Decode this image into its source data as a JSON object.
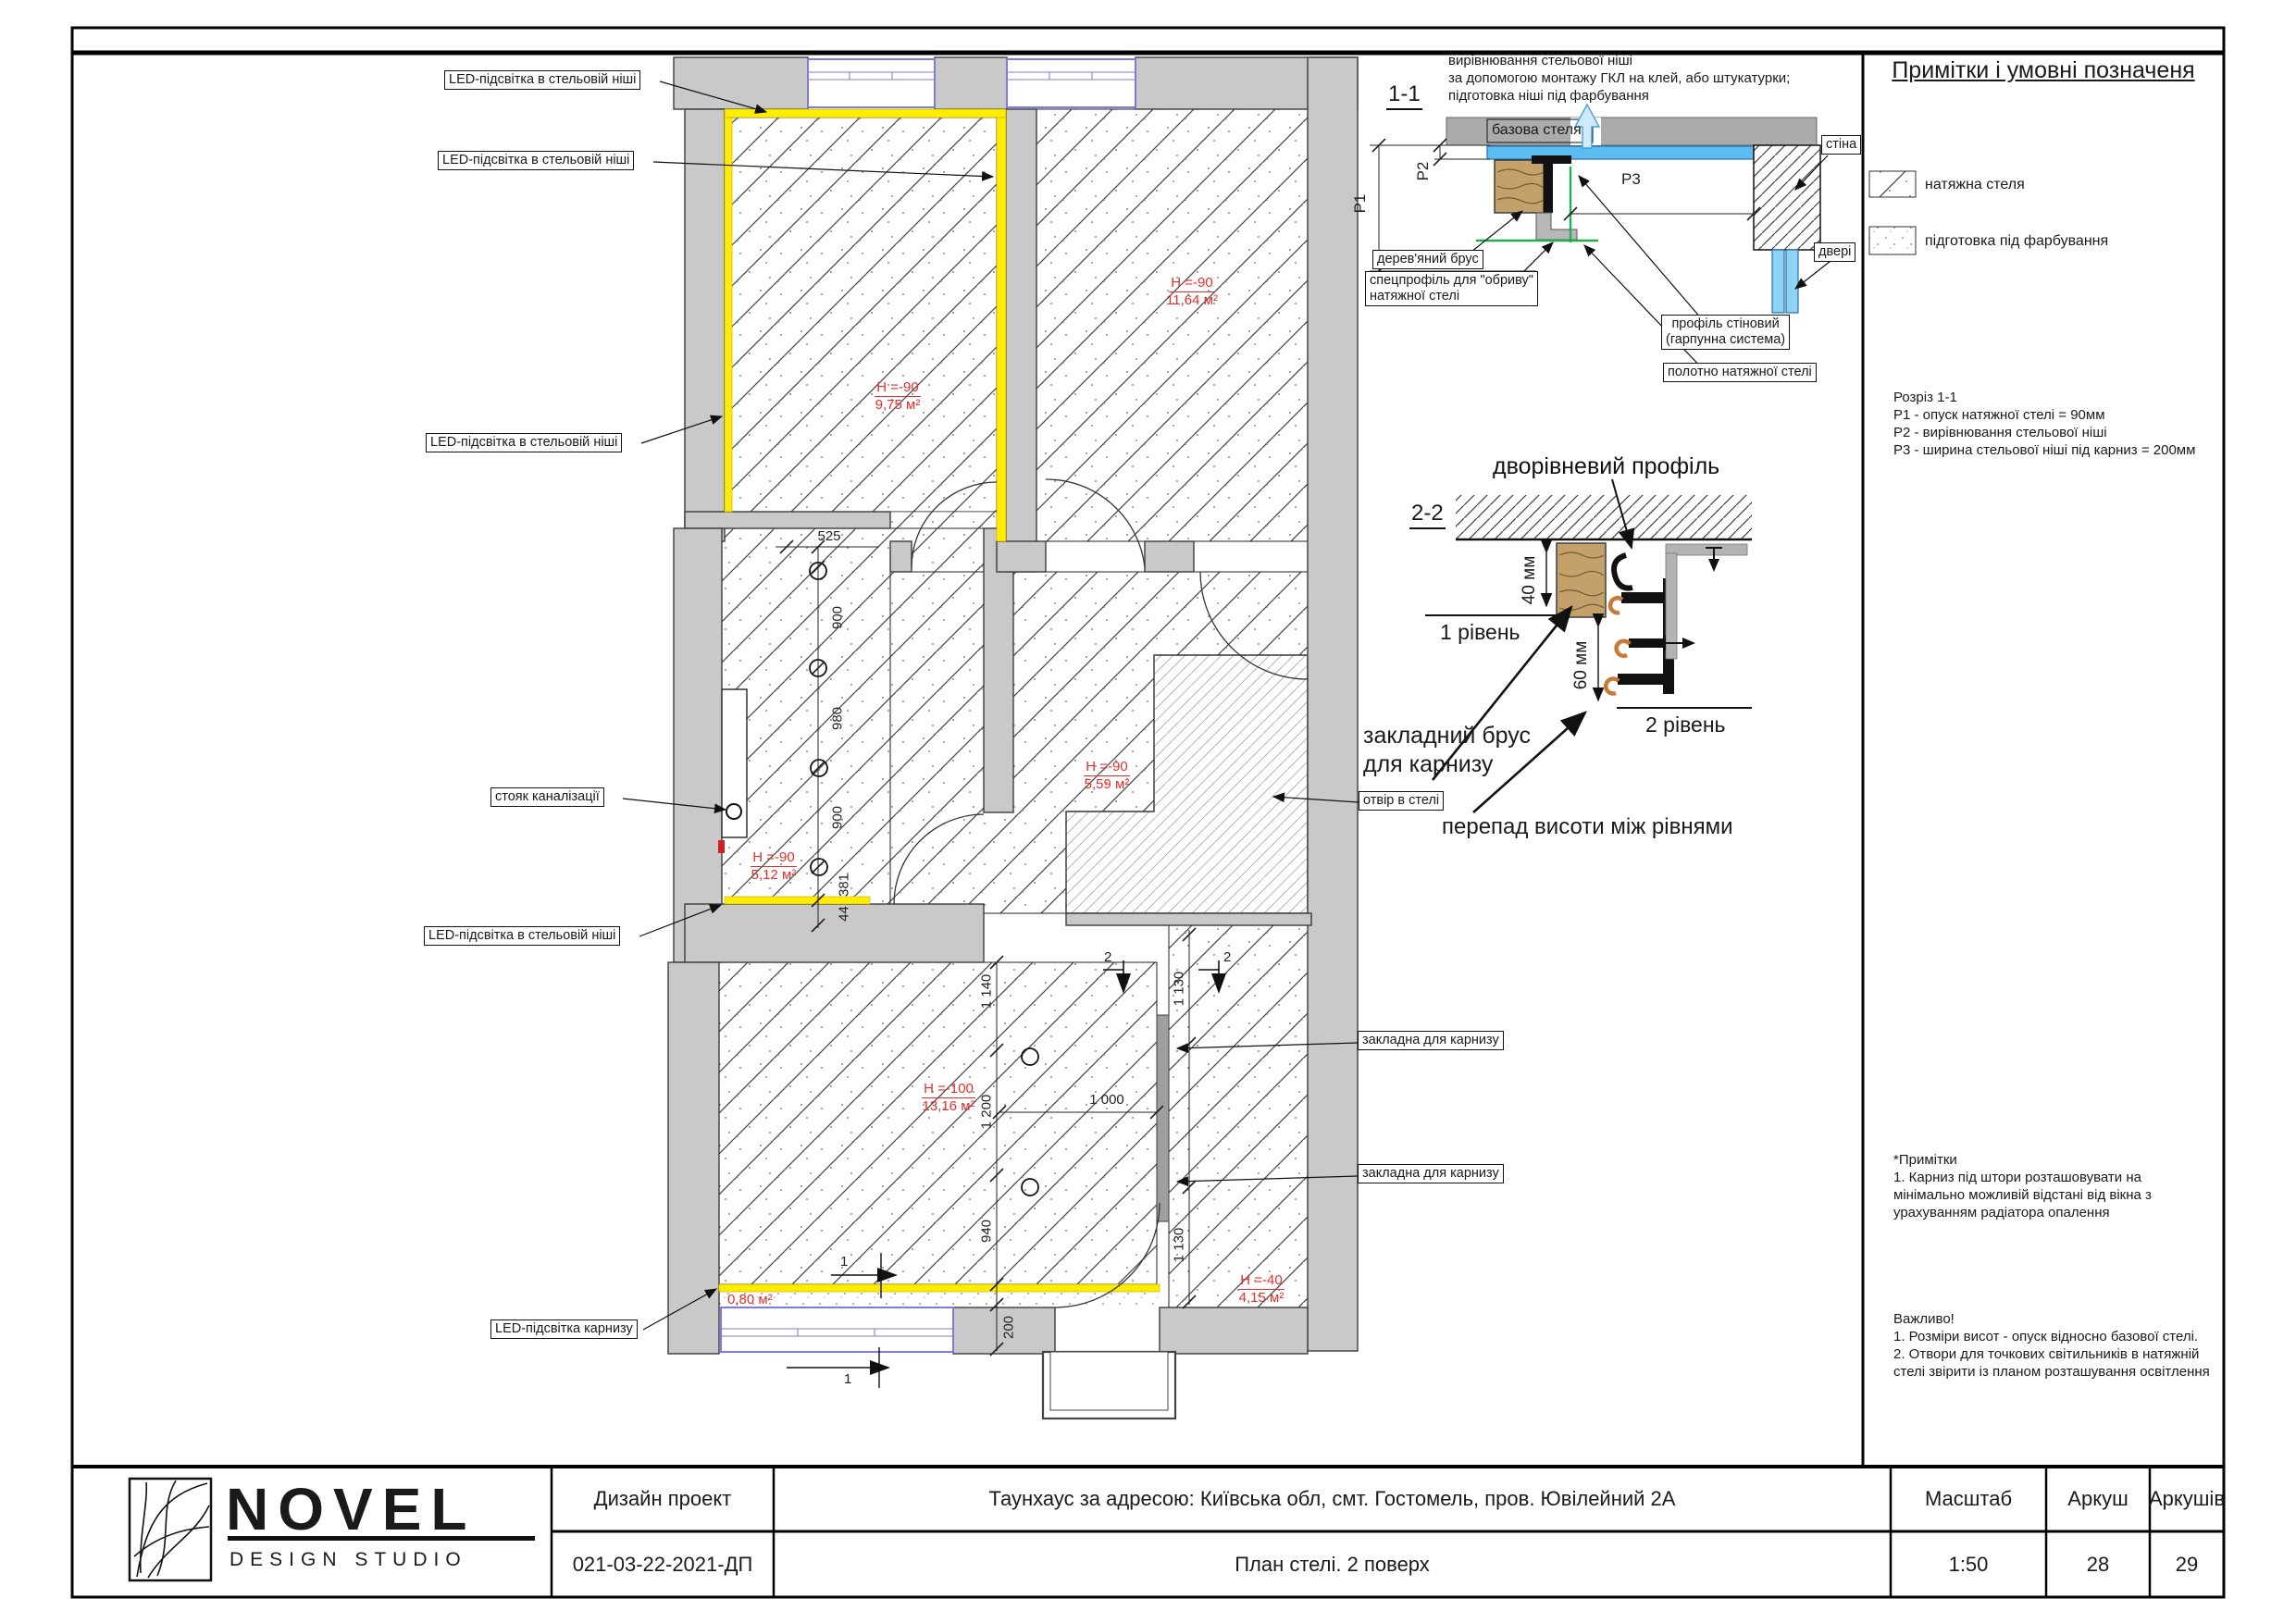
{
  "legend": {
    "title": "Примітки і умовні позначеня",
    "item1": "натяжна стеля",
    "item2": "підготовка під фарбування",
    "section_title": "Розріз 1-1",
    "p1_note": "Р1 - опуск натяжної стелі = 90мм",
    "p2_note": "Р2 - вирівнювання стельової ніші",
    "p3_note": "Р3 - ширина стельової ніші під карниз = 200мм",
    "notes_title": "*Примітки",
    "notes_1": "1. Карниз під штори розташовувати на мінімально можливій відстані від вікна з урахуванням радіатора опалення",
    "important_title": "Важливо!",
    "important_1": "1. Розміри висот - опуск відносно базової стелі.",
    "important_2": "2. Отвори для точкових світильників в натяжній стелі звірити із планом розташування освітлення"
  },
  "detail_1_1": {
    "title": "1-1",
    "note_line1": "вирівнювання стельової ніші",
    "note_line2": "за допомогою монтажу ГКЛ на клей, або штукатурки;",
    "note_line3": "підготовка ніші під фарбування",
    "base_ceiling": "базова стеля",
    "wall": "стіна",
    "door": "двері",
    "p1": "Р1",
    "p2": "Р2",
    "p3": "Р3",
    "wood_beam": "дерев'яний брус",
    "spec_profile_line1": "спецпрофіль для \"обриву\"",
    "spec_profile_line2": "натяжної стелі",
    "wall_profile_line1": "профіль стіновий",
    "wall_profile_line2": "(гарпунна система)",
    "canvas": "полотно натяжної стелі"
  },
  "detail_2_2": {
    "title": "2-2",
    "two_level_profile": "дворівневий профіль",
    "dim40": "40 мм",
    "dim60": "60 мм",
    "level1": "1 рівень",
    "level2": "2 рівень",
    "beam_line1": "закладний брус",
    "beam_line2": "для карнизу",
    "hole": "отвір в стелі",
    "height_diff": "перепад висоти між рівнями"
  },
  "plan": {
    "led_niche": "LED-підсвітка в стельовій ніші",
    "led_cornice": "LED-підсвітка карнизу",
    "sewer": "стояк каналізації",
    "embed_cornice": "закладна для карнизу",
    "rooms": [
      {
        "h": "H =-90",
        "a": "9,75 м²"
      },
      {
        "h": "H =-90",
        "a": "11,64 м²"
      },
      {
        "h": "H =-90",
        "a": "5,12 м²"
      },
      {
        "h": "H =-90",
        "a": "5,59 м²"
      },
      {
        "h": "H =-100",
        "a": "13,16 м²"
      },
      {
        "h": "H =-40",
        "a": "4,15 м²"
      }
    ],
    "area_small": "0,80 м²",
    "dims": {
      "d525": "525",
      "d900a": "900",
      "d980": "980",
      "d900b": "900",
      "d381": "381",
      "d44": "44",
      "d1140": "1 140",
      "d1200": "1 200",
      "d940": "940",
      "d200": "200",
      "d1000": "1 000",
      "d1130a": "1 130",
      "d1130b": "1 130"
    },
    "sec1": "1",
    "sec2": "2"
  },
  "titleblock": {
    "brand": "NOVEL",
    "brand_sub": "DESIGN STUDIO",
    "project_type": "Дизайн проект",
    "project_code": "021-03-22-2021-ДП",
    "address": "Таунхаус за адресою: Київська обл, смт. Гостомель, пров. Ювілейний 2А",
    "sheet_title": "План стелі. 2 поверх",
    "scale_label": "Масштаб",
    "scale_value": "1:50",
    "sheet_label": "Аркуш",
    "sheet_value": "28",
    "sheets_label": "Аркушів",
    "sheets_value": "29"
  }
}
